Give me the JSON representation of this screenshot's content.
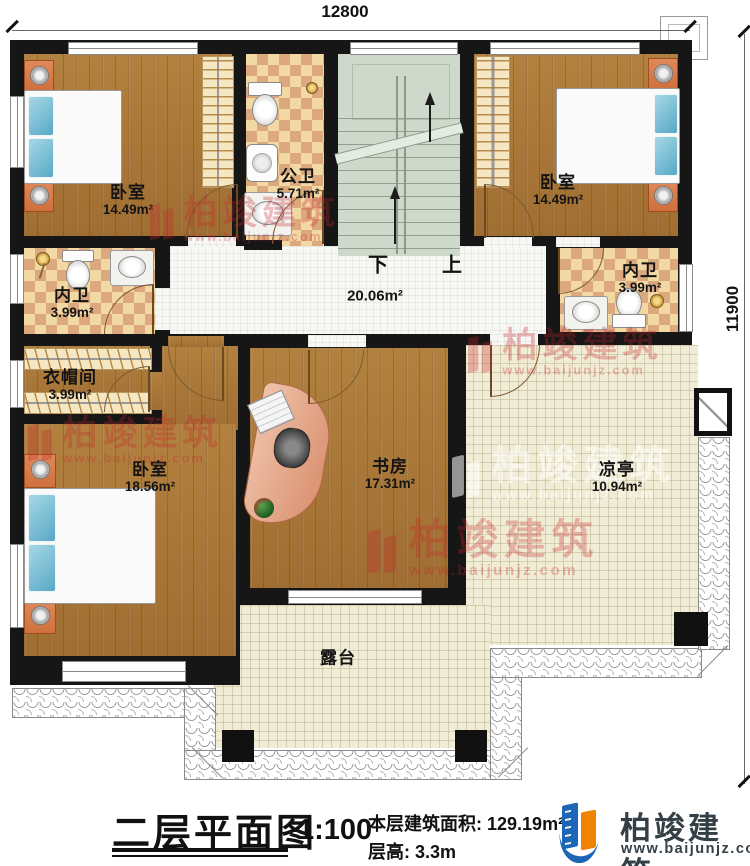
{
  "dims": {
    "width": "12800",
    "height": "11900"
  },
  "rooms": {
    "bedroom_tl": {
      "name": "卧室",
      "area": "14.49m²"
    },
    "bath_public": {
      "name": "公卫",
      "area": "5.71m²"
    },
    "bedroom_tr": {
      "name": "卧室",
      "area": "14.49m²"
    },
    "ensuite_right": {
      "name": "内卫",
      "area": "3.99m²"
    },
    "hallway": {
      "area": "20.06m²"
    },
    "ensuite_left": {
      "name": "内卫",
      "area": "3.99m²"
    },
    "cloakroom": {
      "name": "衣帽间",
      "area": "3.99m²"
    },
    "bedroom_bl": {
      "name": "卧室",
      "area": "18.56m²"
    },
    "study": {
      "name": "书房",
      "area": "17.31m²"
    },
    "pavilion": {
      "name": "凉亭",
      "area": "10.94m²"
    },
    "terrace": {
      "name": "露台"
    }
  },
  "stairs": {
    "down": "下",
    "up": "上"
  },
  "title_block": {
    "title": "二层平面图",
    "scale": "1:100",
    "area_label": "本层建筑面积:",
    "area_value": "129.19m²",
    "floor_height_label": "层高:",
    "floor_height_value": "3.3m"
  },
  "brand": {
    "name": "柏竣建筑",
    "website": "www.baijunjz.com"
  },
  "watermark": {
    "name": "柏竣建筑",
    "website": "www.baijunjz.com"
  },
  "colors": {
    "wall": "#161616",
    "wood_floor": "#a97839",
    "bath_tile": "#f2d8a2",
    "bath_tile_dark": "#dca87e",
    "hall_tile": "#f7f7f4",
    "terrace_tile": "#f1ecd6",
    "stairs": "#ced8cb",
    "bed_blue": "#69bcd8",
    "nightstand_orange": "#cf703d",
    "watermark_red": "#c4262c",
    "logo_blue": "#1d66b5",
    "logo_orange": "#ef8200"
  }
}
